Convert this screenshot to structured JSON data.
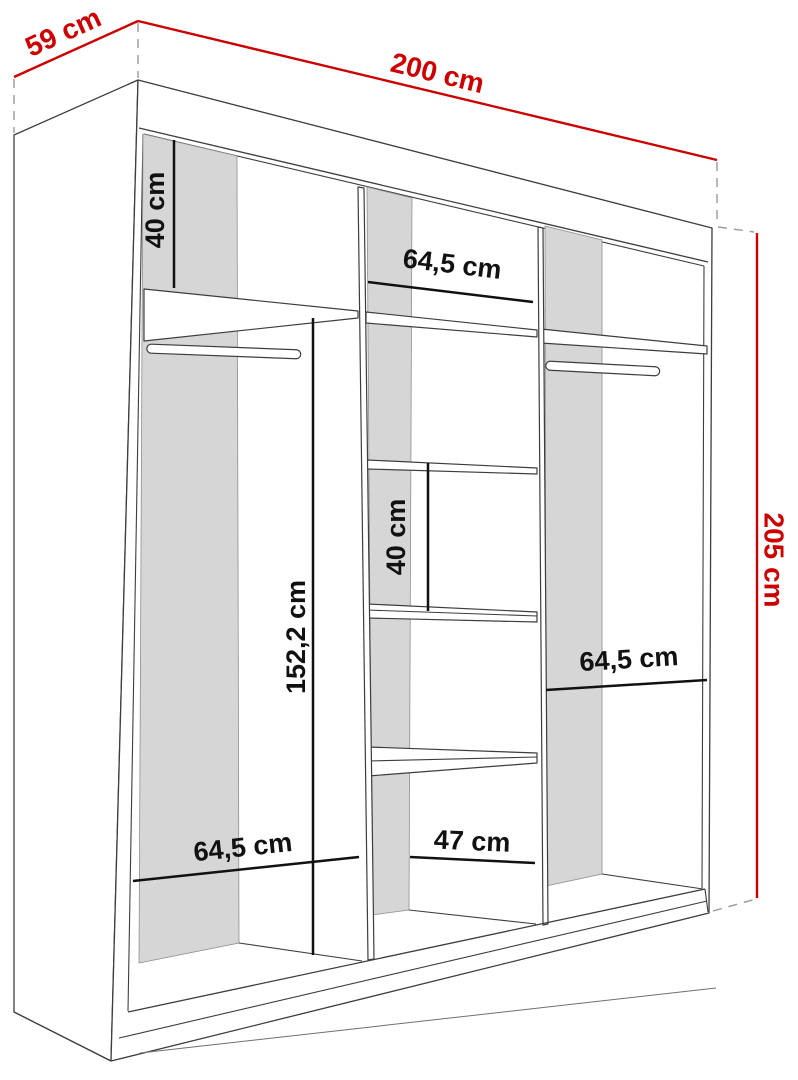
{
  "diagram": {
    "kind": "wardrobe-dimension-drawing",
    "colors": {
      "dimension_red": "#cc0000",
      "dimension_black": "#111111",
      "panel_gray": "#d6d6d6",
      "outline": "#3d3d3d",
      "dashed_extension": "#9a9a9a",
      "background": "#ffffff"
    },
    "overall_dimensions": {
      "depth": {
        "label": "59 cm"
      },
      "width": {
        "label": "200 cm"
      },
      "height": {
        "label": "205 cm"
      }
    },
    "internal_dimensions": [
      {
        "id": "left-top-shelf-gap",
        "label": "40 cm",
        "orientation": "vertical"
      },
      {
        "id": "middle-section-width",
        "label": "64,5 cm",
        "orientation": "horizontal"
      },
      {
        "id": "left-hanging-height",
        "label": "152,2 cm",
        "orientation": "vertical"
      },
      {
        "id": "middle-shelf-gap",
        "label": "40 cm",
        "orientation": "vertical"
      },
      {
        "id": "right-section-width",
        "label": "64,5 cm",
        "orientation": "horizontal"
      },
      {
        "id": "left-section-width",
        "label": "64,5 cm",
        "orientation": "horizontal"
      },
      {
        "id": "middle-bottom-width",
        "label": "47 cm",
        "orientation": "horizontal"
      }
    ]
  }
}
